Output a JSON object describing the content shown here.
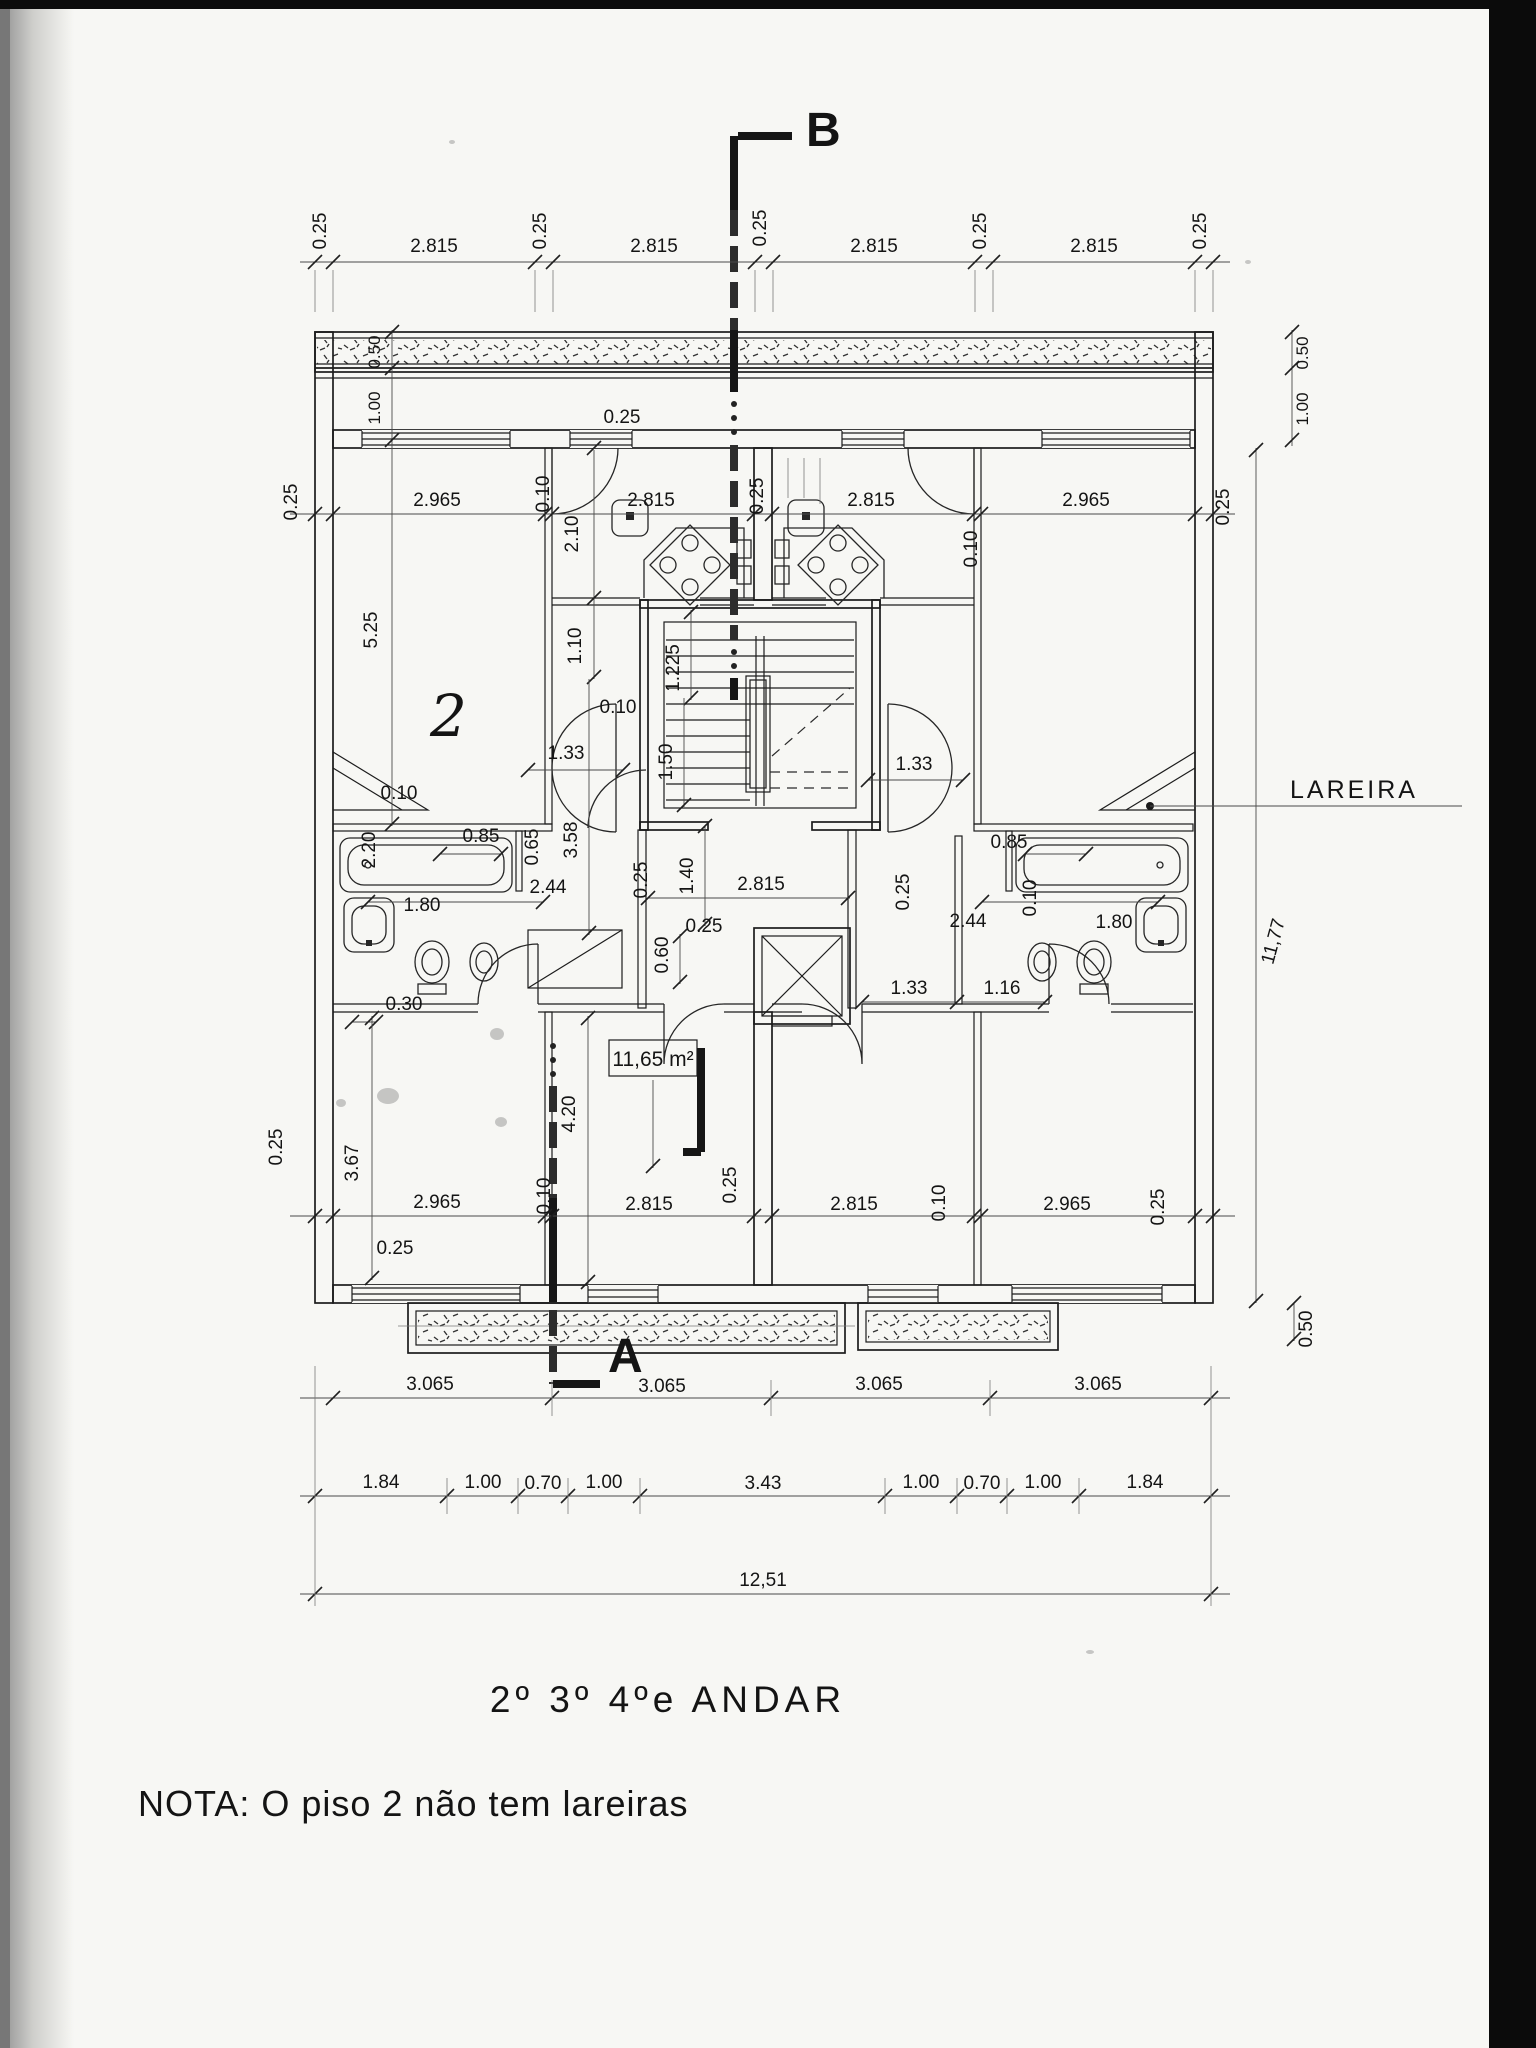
{
  "document": {
    "title": "2º 3º 4ºe ANDAR",
    "note": "NOTA: O  piso 2 não tem lareiras"
  },
  "sections": {
    "top": "B",
    "bottom": "A"
  },
  "callouts": {
    "fireplace": "LAREIRA",
    "area": "11,65 m²",
    "handwritten": "2"
  },
  "dims": {
    "top_chain": [
      "0.25",
      "2.815",
      "0.25",
      "2.815",
      "0.25",
      "2.815",
      "0.25",
      "2.815",
      "0.25"
    ],
    "upper_widths": [
      "2.965",
      "0.10",
      "2.815",
      "0.25",
      "2.815",
      "0.10",
      "2.965"
    ],
    "upper_outer": [
      "0.25",
      "0.25"
    ],
    "terrace_left": [
      "0.50",
      "1.00"
    ],
    "terrace_right": [
      "0.50",
      "1.00"
    ],
    "top_wall": "0.25",
    "kitchen_depth": "2.10",
    "sala_height": "5.25",
    "corridor": [
      "1.10",
      "0.10",
      "1.33",
      "1.225",
      "1.50",
      "3.58"
    ],
    "hall": [
      "1.40",
      "2.815",
      "0.25",
      "0.25",
      "0.25",
      "0.60"
    ],
    "bath_left": [
      "2.20",
      "0.85",
      "0.65",
      "2.44",
      "1.80",
      "0.10",
      "0.30"
    ],
    "bath_right": [
      "0.85",
      "2.44",
      "0.10",
      "1.80"
    ],
    "right_wing": [
      "1.33",
      "1.33",
      "1.16"
    ],
    "lower_widths": [
      "2.965",
      "0.10",
      "2.815",
      "0.25",
      "2.815",
      "0.10",
      "2.965",
      "0.25"
    ],
    "lower_outer": [
      "0.25",
      "0.25"
    ],
    "room_heights": [
      "3.67",
      "4.20"
    ],
    "right_height": "11,77",
    "right_balcony_depth": "0.50",
    "chain_3065": [
      "3.065",
      "3.065",
      "3.065",
      "3.065"
    ],
    "chain_detail": [
      "1.84",
      "1.00",
      "0.70",
      "1.00",
      "3.43",
      "1.00",
      "0.70",
      "1.00",
      "1.84"
    ],
    "chain_total": "12,51"
  }
}
